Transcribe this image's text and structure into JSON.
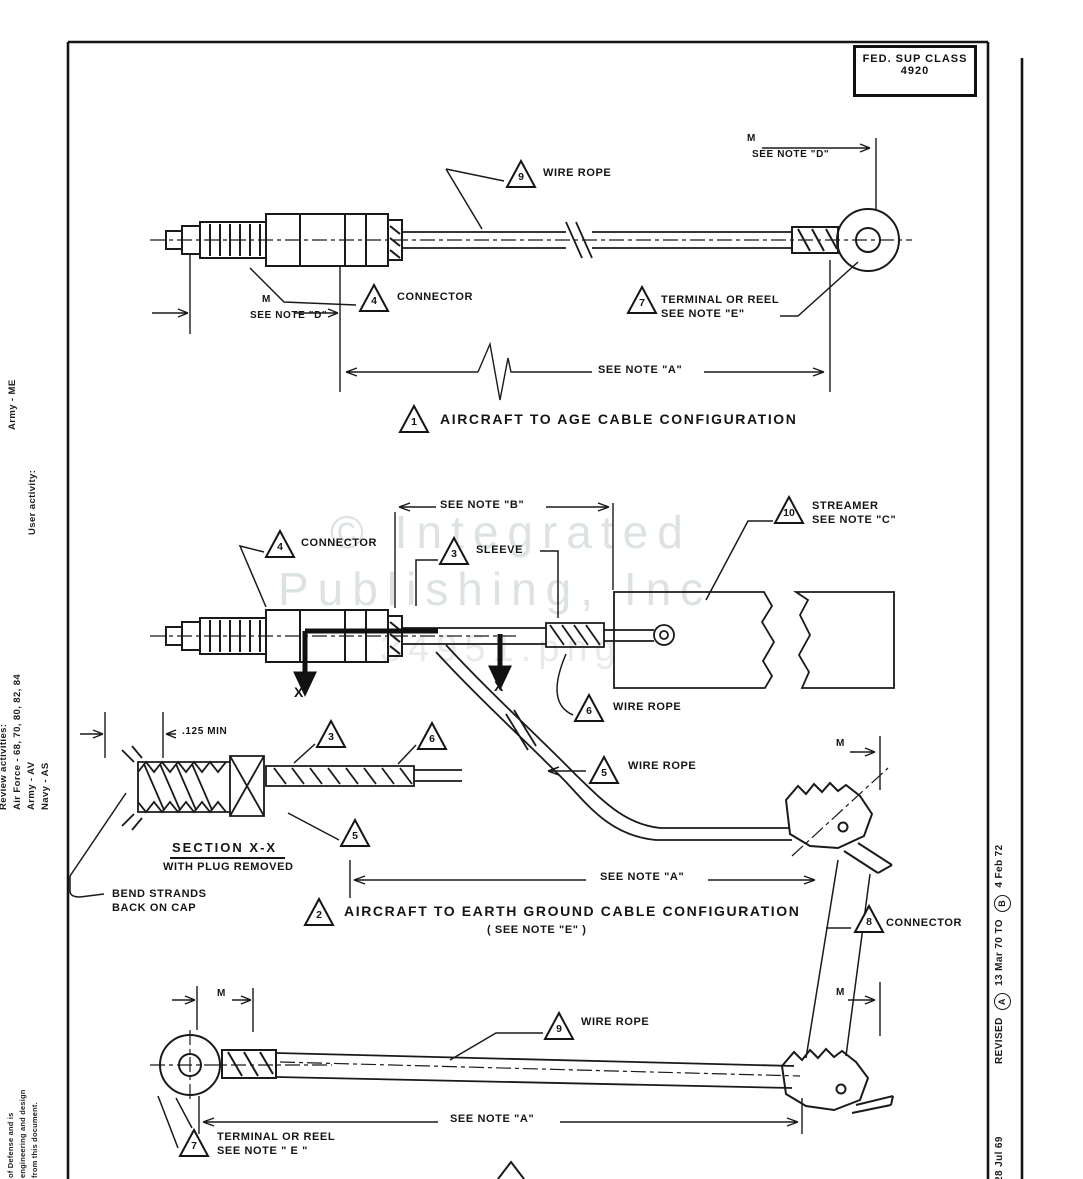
{
  "colors": {
    "ink": "#151515",
    "paper": "#ffffff",
    "watermark": "#dde3e1"
  },
  "header": {
    "fsc_line1": "FED. SUP CLASS",
    "fsc_line2": "4920"
  },
  "watermark": {
    "line1": "© Integrated",
    "line2": "Publishing, Inc",
    "line3": "34951.png"
  },
  "margin_left": {
    "user_activity": "User activity:",
    "user_activity_value": "Army - ME",
    "review_activities": "Review activities:",
    "review_air_force": "Air Force - 68, 70, 80, 82, 84",
    "review_army": "Army - AV",
    "review_navy": "Navy - AS",
    "fine_print_1": "of Defense and is",
    "fine_print_2": "engineering and design",
    "fine_print_3": "from this document."
  },
  "margin_right": {
    "date": "28 Jul 69",
    "revised": "REVISED",
    "rev_a": "A",
    "rev_a_date": "13 Mar 70",
    "to": "TO",
    "rev_b": "B",
    "rev_b_date": "4 Feb 72"
  },
  "config1": {
    "callout_wire_rope": "9",
    "wire_rope_label": "WIRE ROPE",
    "m_right": "M",
    "see_note_d_right": "SEE NOTE \"D\"",
    "callout_connector": "4",
    "connector_label": "CONNECTOR",
    "m_left": "M",
    "see_note_d_left": "SEE NOTE \"D\"",
    "callout_terminal": "7",
    "terminal_label_1": "TERMINAL OR REEL",
    "terminal_label_2": "SEE NOTE \"E\"",
    "see_note_a": "SEE NOTE \"A\"",
    "title_num": "1",
    "title": "AIRCRAFT TO AGE CABLE CONFIGURATION"
  },
  "config2": {
    "see_note_b": "SEE NOTE \"B\"",
    "callout_streamer": "10",
    "streamer_label_1": "STREAMER",
    "streamer_label_2": "SEE NOTE \"C\"",
    "callout_connector": "4",
    "connector_label": "CONNECTOR",
    "callout_sleeve": "3",
    "sleeve_label": "SLEEVE",
    "callout_wire_rope_upper": "6",
    "wire_rope_upper_label": "WIRE ROPE",
    "callout_wire_rope_lower": "5",
    "wire_rope_lower_label": "WIRE ROPE",
    "x_left": "X",
    "x_right": "X",
    "m_right": "M",
    "see_note_a": "SEE NOTE \"A\"",
    "callout_clamp": "8",
    "clamp_label": "CONNECTOR",
    "title_num": "2",
    "title": "AIRCRAFT TO EARTH GROUND CABLE CONFIGURATION",
    "subtitle": "( SEE NOTE \"E\" )"
  },
  "section_view": {
    "dim": ".125 MIN",
    "callout_sleeve": "3",
    "callout_rope_a": "6",
    "callout_rope_b": "5",
    "title": "SECTION  X-X",
    "subtitle": "WITH PLUG REMOVED",
    "note_line_1": "BEND STRANDS",
    "note_line_2": "BACK ON CAP"
  },
  "config3": {
    "m_left": "M",
    "m_right": "M",
    "callout_wire_rope": "9",
    "wire_rope_label": "WIRE ROPE",
    "see_note_a": "SEE NOTE \"A\"",
    "callout_terminal": "7",
    "terminal_label_1": "TERMINAL OR REEL",
    "terminal_label_2": "SEE NOTE \" E \""
  }
}
